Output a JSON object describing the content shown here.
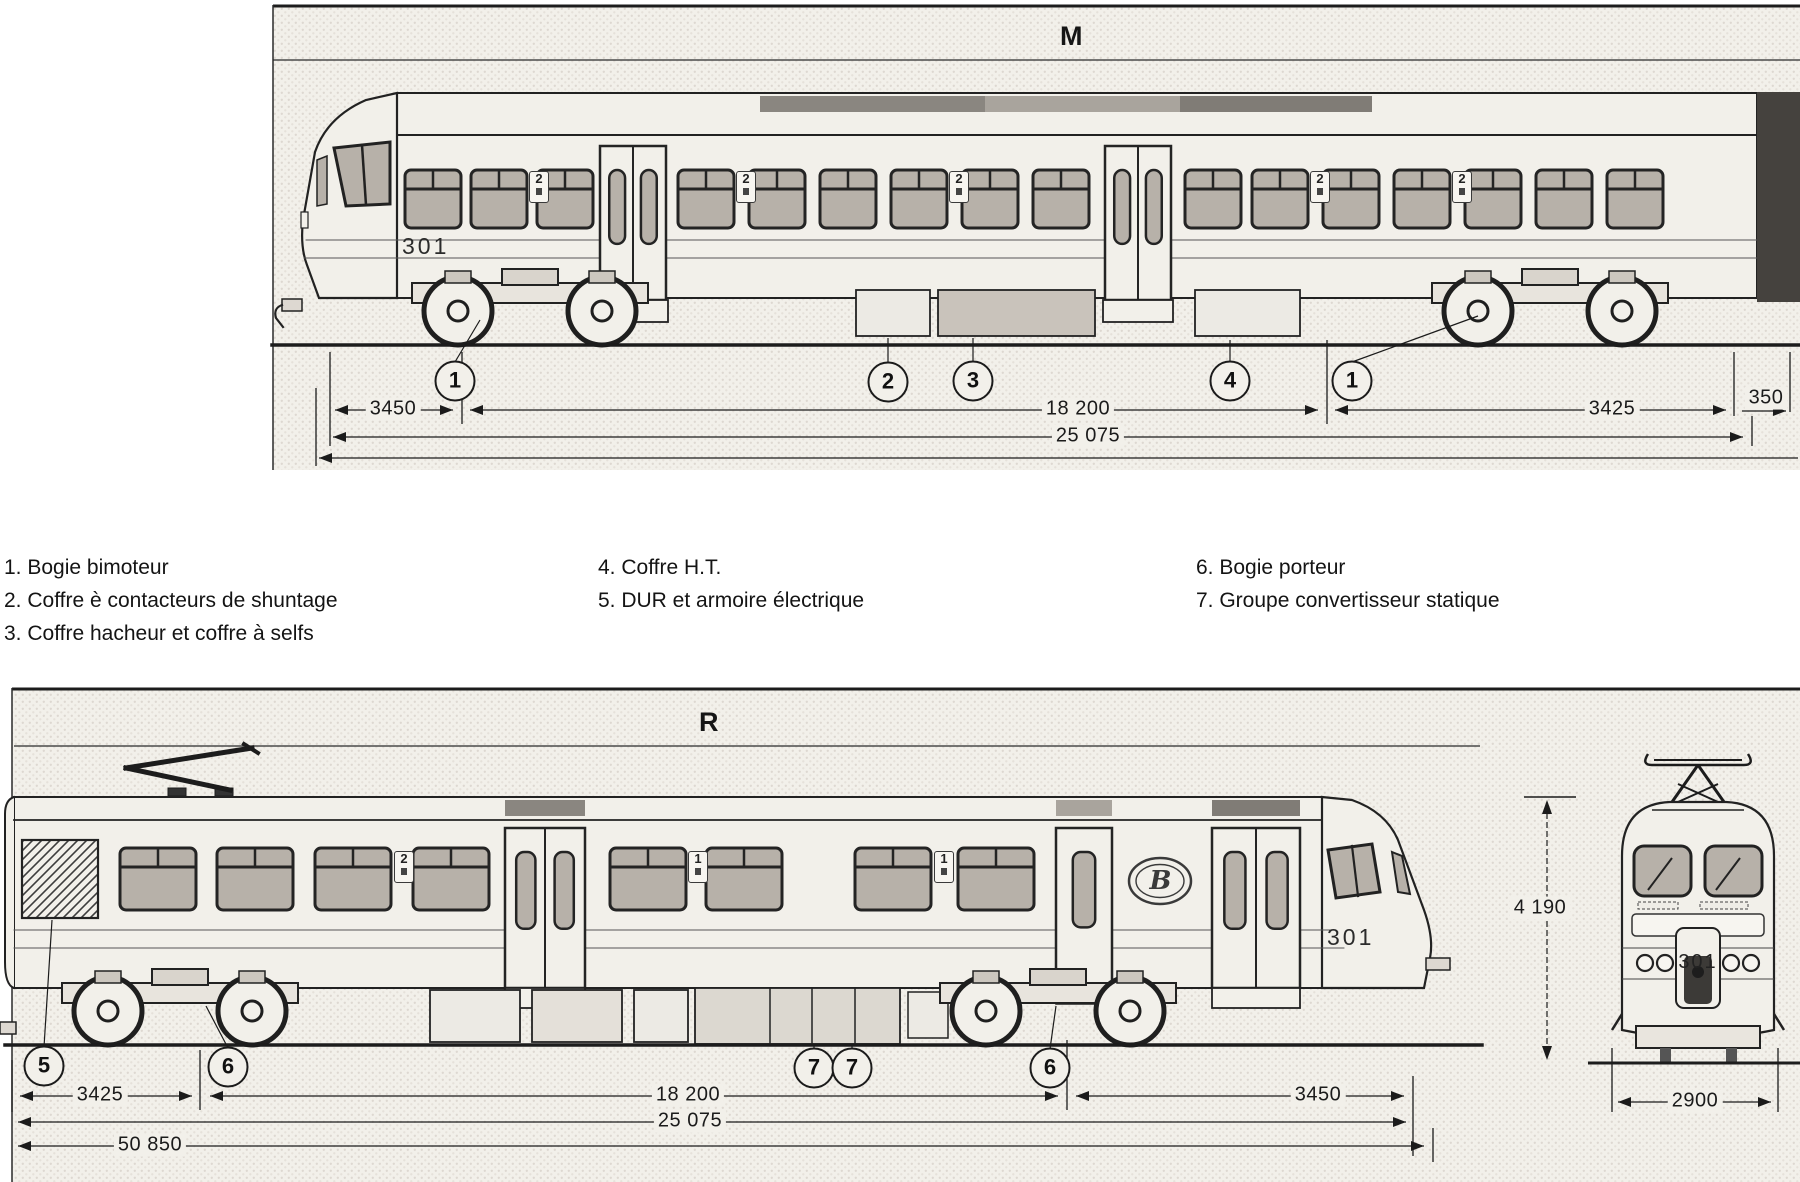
{
  "colors": {
    "ink": "#1f1f1f",
    "paper": "#ffffff",
    "halftone": "#f2f0ea",
    "window_glass": "#b7b1a9"
  },
  "diagram_m": {
    "title": "M",
    "train_number": "301",
    "class_markers": [
      {
        "t": "2",
        "x": 529,
        "y": 171
      },
      {
        "t": "2",
        "x": 736,
        "y": 171
      },
      {
        "t": "2",
        "x": 949,
        "y": 171
      },
      {
        "t": "2",
        "x": 1310,
        "y": 171
      },
      {
        "t": "2",
        "x": 1452,
        "y": 171
      }
    ],
    "callouts": [
      {
        "n": "1",
        "x": 455,
        "y": 381
      },
      {
        "n": "2",
        "x": 888,
        "y": 382
      },
      {
        "n": "3",
        "x": 973,
        "y": 381
      },
      {
        "n": "4",
        "x": 1230,
        "y": 381
      },
      {
        "n": "1",
        "x": 1352,
        "y": 381
      }
    ],
    "dimensions": [
      {
        "t": "3450",
        "x": 393,
        "y": 410
      },
      {
        "t": "18 200",
        "x": 1078,
        "y": 410
      },
      {
        "t": "3425",
        "x": 1612,
        "y": 410
      },
      {
        "t": "350",
        "x": 1766,
        "y": 399
      },
      {
        "t": "25 075",
        "x": 1088,
        "y": 437
      }
    ]
  },
  "legend": {
    "columns": [
      {
        "items": [
          "1. Bogie bimoteur",
          "2. Coffre è contacteurs de shuntage",
          "3. Coffre hacheur et coffre à selfs"
        ]
      },
      {
        "items": [
          "4. Coffre H.T.",
          "5. DUR et armoire électrique"
        ]
      },
      {
        "items": [
          "6. Bogie porteur",
          "7. Groupe convertisseur statique"
        ]
      }
    ]
  },
  "diagram_r": {
    "title": "R",
    "train_number": "301",
    "front_number": "301",
    "logo": "B",
    "class_markers": [
      {
        "t": "2",
        "x": 394,
        "y": 851
      },
      {
        "t": "1",
        "x": 688,
        "y": 851
      },
      {
        "t": "1",
        "x": 934,
        "y": 851
      }
    ],
    "callouts": [
      {
        "n": "5",
        "x": 44,
        "y": 1066
      },
      {
        "n": "6",
        "x": 228,
        "y": 1067
      },
      {
        "n": "7",
        "x": 814,
        "y": 1068
      },
      {
        "n": "7",
        "x": 852,
        "y": 1068
      },
      {
        "n": "6",
        "x": 1050,
        "y": 1068
      }
    ],
    "dimensions": [
      {
        "t": "3425",
        "x": 100,
        "y": 1096
      },
      {
        "t": "18 200",
        "x": 688,
        "y": 1096
      },
      {
        "t": "3450",
        "x": 1318,
        "y": 1096
      },
      {
        "t": "25 075",
        "x": 690,
        "y": 1122
      },
      {
        "t": "50 850",
        "x": 150,
        "y": 1146
      },
      {
        "t": "2900",
        "x": 1695,
        "y": 1102
      },
      {
        "t": "4 190",
        "x": 1540,
        "y": 909
      }
    ]
  }
}
